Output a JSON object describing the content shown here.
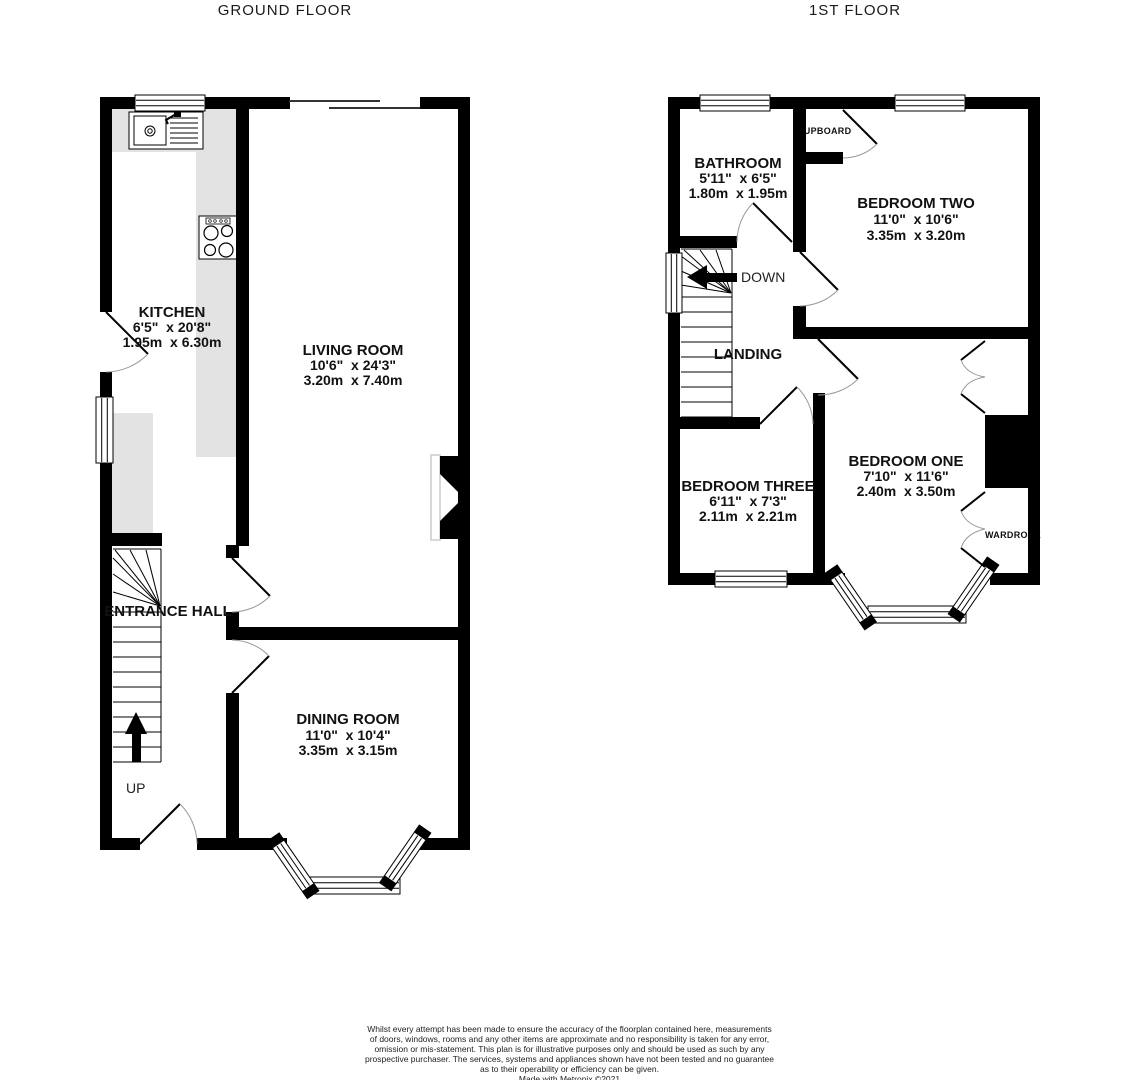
{
  "titles": {
    "ground": "GROUND FLOOR",
    "first": "1ST FLOOR"
  },
  "ground_floor": {
    "kitchen": {
      "name": "KITCHEN",
      "imperial": "6'5\"  x 20'8\"",
      "metric": "1.95m  x 6.30m"
    },
    "living_room": {
      "name": "LIVING ROOM",
      "imperial": "10'6\"  x 24'3\"",
      "metric": "3.20m  x 7.40m"
    },
    "entrance_hall": {
      "name": "ENTRANCE HALL"
    },
    "dining_room": {
      "name": "DINING ROOM",
      "imperial": "11'0\"  x 10'4\"",
      "metric": "3.35m  x 3.15m"
    },
    "stairs_label": "UP"
  },
  "first_floor": {
    "bathroom": {
      "name": "BATHROOM",
      "imperial": "5'11\"  x 6'5\"",
      "metric": "1.80m  x 1.95m"
    },
    "bedroom_two": {
      "name": "BEDROOM TWO",
      "imperial": "11'0\"  x 10'6\"",
      "metric": "3.35m  x 3.20m"
    },
    "bedroom_three": {
      "name": "BEDROOM THREE",
      "imperial": "6'11\"  x 7'3\"",
      "metric": "2.11m  x 2.21m"
    },
    "bedroom_one": {
      "name": "BEDROOM ONE",
      "imperial": "7'10\"  x 11'6\"",
      "metric": "2.40m  x 3.50m"
    },
    "landing": {
      "name": "LANDING"
    },
    "cupboard": "CUPBOARD",
    "wardrobe": "WARDROBE",
    "stairs_label": "DOWN"
  },
  "disclaimer": {
    "lines": [
      "Whilst every attempt has been made to ensure the accuracy of the floorplan contained here, measurements",
      "of doors, windows, rooms and any other items are approximate and no responsibility is taken for any error,",
      "omission or mis-statement. This plan is for illustrative purposes only and should be used as such by any",
      "prospective purchaser. The services, systems and appliances shown have not been tested and no guarantee",
      "as to their operability or efficiency can be given.",
      "Made with Metropix ©2021"
    ]
  },
  "colors": {
    "wall": "#000000",
    "counter": "#e3e3e3",
    "text": "#111111"
  }
}
